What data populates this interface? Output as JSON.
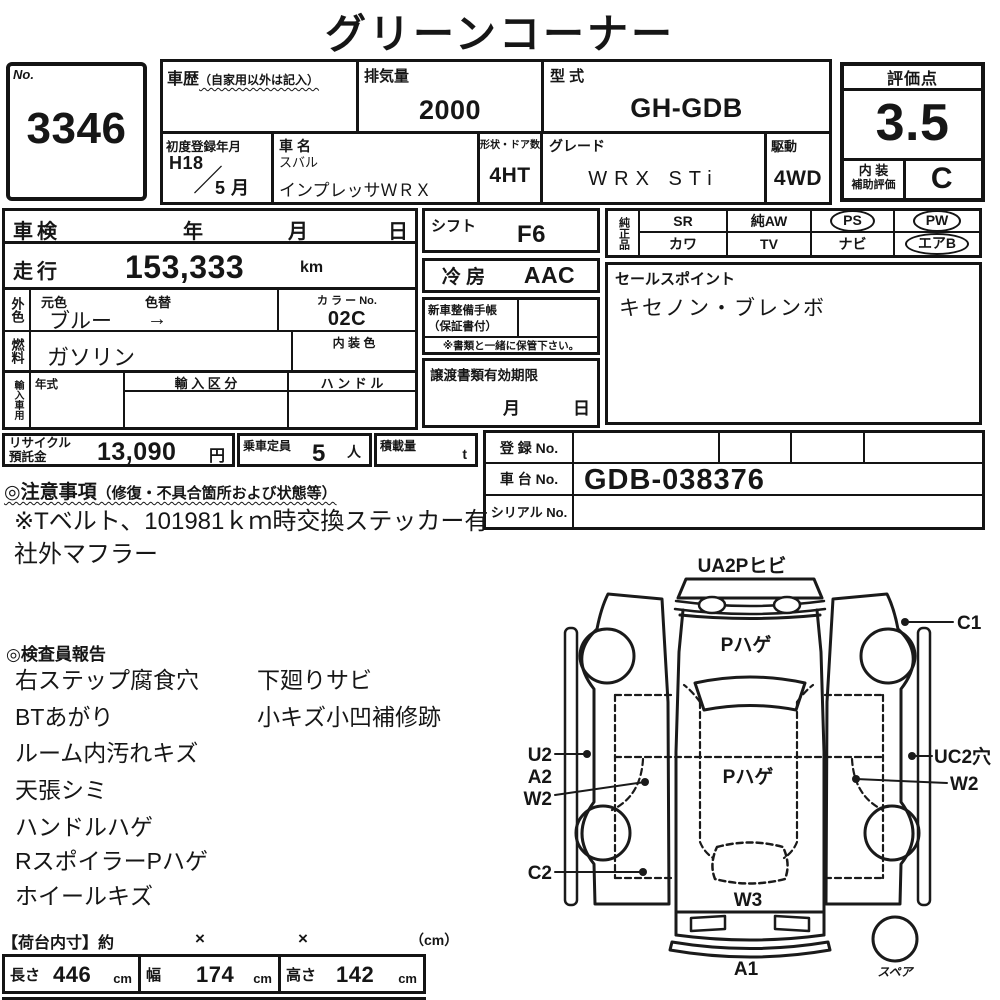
{
  "title": "グリーンコーナー",
  "no_box": {
    "label": "No.",
    "value": "3346"
  },
  "history": {
    "label": "車歴",
    "note": "（自家用以外は記入）"
  },
  "displacement": {
    "label": "排気量",
    "value": "2000"
  },
  "model_code": {
    "label": "型 式",
    "value": "GH-GDB"
  },
  "first_reg": {
    "label": "初度登録年月",
    "year": "H18",
    "slash": "／",
    "month": "5 月"
  },
  "car_name": {
    "label": "車 名",
    "maker": "スバル",
    "model": "インプレッサＷＲＸ"
  },
  "body_doors": {
    "label": "形状・ドア数",
    "value": "4HT"
  },
  "grade": {
    "label": "グレード",
    "value": "WRX STi"
  },
  "drive": {
    "label": "駆動",
    "value": "4WD"
  },
  "rating": {
    "label": "評価点",
    "score": "3.5",
    "interior_label1": "内 装",
    "interior_label2": "補助評価",
    "interior_grade": "C"
  },
  "shaken": {
    "label": "車検",
    "year": "年",
    "month": "月",
    "day": "日"
  },
  "mileage": {
    "label": "走行",
    "value": "153,333",
    "unit": "km"
  },
  "exterior": {
    "side_label": "外色",
    "orig_label": "元色",
    "change_label": "色替",
    "value": "ブルー",
    "arrow": "→",
    "color_no_label": "カ ラ ー No.",
    "color_no": "02C"
  },
  "fuel": {
    "side_label": "燃料",
    "value": "ガソリン",
    "interior_color_label": "内 装 色"
  },
  "import": {
    "side_label": "輸入車用",
    "year_label": "年式",
    "division_label": "輸 入 区 分",
    "handle_label": "ハ ン ド ル"
  },
  "shift": {
    "label": "シフト",
    "value": "F6"
  },
  "aircon": {
    "label": "冷 房",
    "value": "AAC"
  },
  "service_book": {
    "label1": "新車整備手帳",
    "label2": "（保証書付）",
    "note": "※書類と一緒に保管下さい。"
  },
  "transfer_docs": {
    "label": "譲渡書類有効期限",
    "month": "月",
    "day": "日"
  },
  "options": {
    "side_label": "純正品",
    "items": [
      {
        "label": "SR",
        "circled": false
      },
      {
        "label": "純AW",
        "circled": false
      },
      {
        "label": "PS",
        "circled": true
      },
      {
        "label": "PW",
        "circled": true
      },
      {
        "label": "カワ",
        "circled": false
      },
      {
        "label": "TV",
        "circled": false
      },
      {
        "label": "ナビ",
        "circled": false
      },
      {
        "label": "エアB",
        "circled": true
      }
    ]
  },
  "sales_point": {
    "label": "セールスポイント",
    "value": "キセノン・ブレンボ"
  },
  "recycle": {
    "label1": "リサイクル",
    "label2": "預託金",
    "value": "13,090",
    "unit": "円"
  },
  "capacity": {
    "label": "乗車定員",
    "value": "5",
    "unit": "人"
  },
  "payload": {
    "label": "積載量",
    "unit": "t"
  },
  "registration": {
    "reg_label": "登 録 No.",
    "chassis_label": "車 台 No.",
    "chassis_value": "GDB-038376",
    "serial_label": "シリアル No."
  },
  "notes": {
    "heading": "◎注意事項",
    "heading_note": "（修復・不具合箇所および状態等）",
    "line1": "※Tベルト、101981ｋｍ時交換ステッカー有",
    "line2": "社外マフラー"
  },
  "inspector": {
    "heading": "◎検査員報告",
    "col1": [
      "右ステップ腐食穴",
      "BTあがり",
      "ルーム内汚れキズ",
      "天張シミ",
      "ハンドルハゲ",
      "RスポイラーPハゲ",
      "ホイールキズ"
    ],
    "col2": [
      "下廻りサビ",
      "小キズ小凹補修跡"
    ]
  },
  "diagram": {
    "top_label": "UA2Pヒビ",
    "hood": "Pハゲ",
    "c1": "C1",
    "u2": "U2",
    "a2": "A2",
    "w2_left": "W2",
    "uc2": "UC2穴",
    "roof": "Pハゲ",
    "w2_right": "W2",
    "c2": "C2",
    "w3": "W3",
    "a1": "A1",
    "spare": "スペア"
  },
  "cargo": {
    "heading": "【荷台内寸】約",
    "times1": "×",
    "times2": "×",
    "unit": "（cm）",
    "length_label": "長さ",
    "length_value": "446",
    "length_unit": "cm",
    "width_label": "幅",
    "width_value": "174",
    "width_unit": "cm",
    "height_label": "高さ",
    "height_value": "142",
    "height_unit": "cm"
  }
}
